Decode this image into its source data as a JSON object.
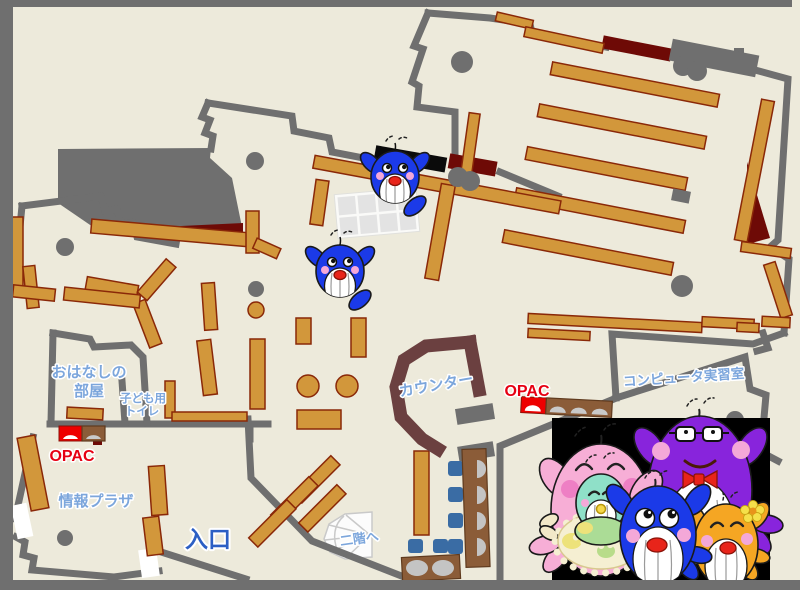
{
  "labels": {
    "storytelling_room_1": "おはなしの",
    "storytelling_room_2": "部屋",
    "kids_toilet_1": "子ども用",
    "kids_toilet_2": "トイレ",
    "opac_left": "OPAC",
    "info_plaza": "情報プラザ",
    "entrance": "入口",
    "counter": "カウンター",
    "opac_center": "OPAC",
    "computer_room": "コンピュータ実習室",
    "to_second_floor": "二階へ"
  },
  "colors": {
    "floor": "#EDEADB",
    "wall_gray": "#6F6F6F",
    "shelf_orange": "#D2973B",
    "shelf_border": "#8A2808",
    "dark_red": "#6E0A06",
    "counter_brown": "#6B4040",
    "desk_brown": "#8B5C38",
    "chair_blue": "#3A6CA4",
    "label_blue": "#7CA6DC",
    "entrance_blue": "#2C5FC4",
    "opac_red": "#E60012",
    "mascot_blue": "#1B3AE8",
    "mascot_pink": "#F7AED6",
    "mascot_purple": "#8824DC",
    "mascot_orange": "#F5A623",
    "mascot_teal": "#8FE0C8"
  },
  "mascots": {
    "map_whales": "blue-whale-mascot",
    "family": [
      "pink-mother-whale",
      "baby-teal-whale",
      "blue-child-whale",
      "purple-father-whale",
      "orange-child-whale"
    ]
  }
}
